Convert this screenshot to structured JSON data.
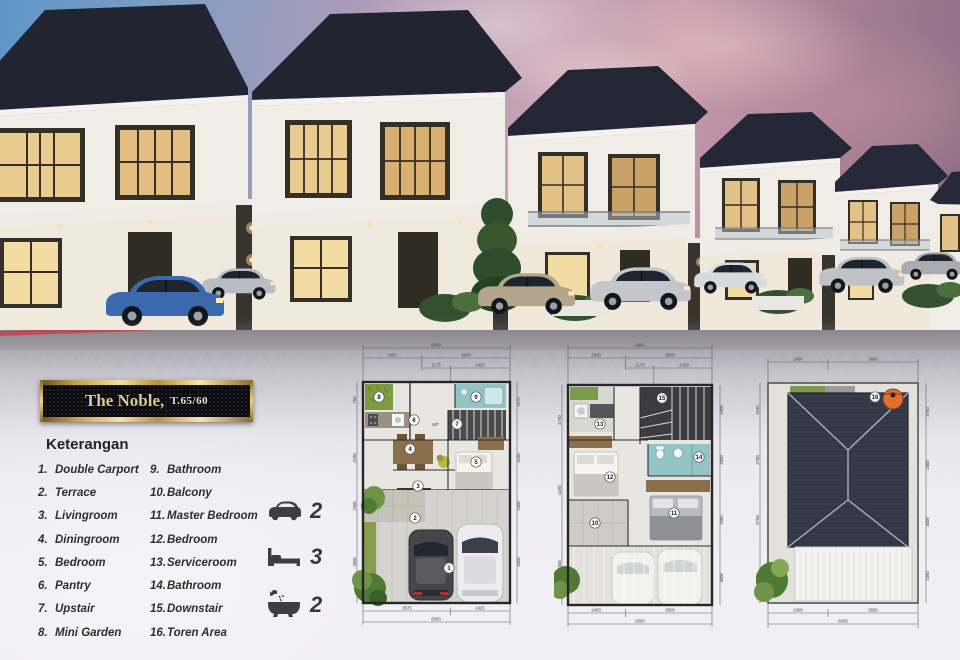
{
  "badge": {
    "title": "The Noble,",
    "spec": "T.65/60"
  },
  "legend": {
    "heading": "Keterangan",
    "col1": [
      {
        "num": "1.",
        "name": "Double Carport"
      },
      {
        "num": "2.",
        "name": "Terrace"
      },
      {
        "num": "3.",
        "name": "Livingroom"
      },
      {
        "num": "4.",
        "name": "Diningroom"
      },
      {
        "num": "5.",
        "name": "Bedroom"
      },
      {
        "num": "6.",
        "name": "Pantry"
      },
      {
        "num": "7.",
        "name": "Upstair"
      },
      {
        "num": "8.",
        "name": "Mini Garden"
      }
    ],
    "col2": [
      {
        "num": "9.",
        "name": "Bathroom"
      },
      {
        "num": "10.",
        "name": "Balcony"
      },
      {
        "num": "11.",
        "name": "Master Bedroom"
      },
      {
        "num": "12.",
        "name": "Bedroom"
      },
      {
        "num": "13.",
        "name": "Serviceroom"
      },
      {
        "num": "14.",
        "name": "Bathroom"
      },
      {
        "num": "15.",
        "name": "Downstair"
      },
      {
        "num": "16.",
        "name": "Toren Area"
      }
    ]
  },
  "stats": [
    {
      "icon": "car-icon",
      "value": "2"
    },
    {
      "icon": "bed-icon",
      "value": "3"
    },
    {
      "icon": "bathtub-icon",
      "value": "2"
    }
  ],
  "plans": {
    "p1": {
      "stair_label": "UP",
      "rooms": {
        "mini_garden": "8",
        "pantry": "6",
        "bathroom": "9",
        "upstair": "7",
        "dining": "4",
        "bedroom": "5",
        "living": "3",
        "terrace": "2",
        "carport": "1"
      },
      "dims": {
        "top_total": "6000",
        "top_a": "2400",
        "top_b": "3600",
        "top_c": "1175",
        "top_d": "2425",
        "bottom_a": "3575",
        "bottom_b": "2425",
        "bottom_total": "6000",
        "left": [
          "750",
          "4250",
          "1500",
          "3500"
        ],
        "right": [
          "1575",
          "3250",
          "1500",
          "4000"
        ]
      }
    },
    "p2": {
      "stair_label": "DN",
      "rooms": {
        "serviceroom": "13",
        "downstair": "15",
        "bathroom": "14",
        "bedroom": "12",
        "master": "11",
        "balcony": "10"
      },
      "dims": {
        "top_total": "6000",
        "top_a": "2400",
        "top_b": "3600",
        "top_c": "1175",
        "top_d": "2425",
        "bottom_a": "2400",
        "bottom_b": "3600",
        "bottom_total": "6000",
        "left": [
          "2750",
          "4250",
          "1500"
        ],
        "right": [
          "1500",
          "2000",
          "3500",
          "3000"
        ]
      }
    },
    "p3": {
      "rooms": {
        "toren": "16"
      },
      "dims": {
        "top_a": "2400",
        "top_b": "3600",
        "bottom_a": "2400",
        "bottom_b": "3600",
        "bottom_total": "6000",
        "left": [
          "1540",
          "2700",
          "5750",
          "3750"
        ],
        "right": [
          "3750",
          "2800",
          "3000",
          "2450"
        ]
      }
    }
  },
  "colors": {
    "gold": "#caa64e",
    "badge_black": "#0b0b10",
    "roof": "#222633",
    "curb_red": "#b23240",
    "plan_teal": "#93c4c6",
    "plan_green": "#7d9c3f",
    "toren_orange": "#e0702e"
  }
}
